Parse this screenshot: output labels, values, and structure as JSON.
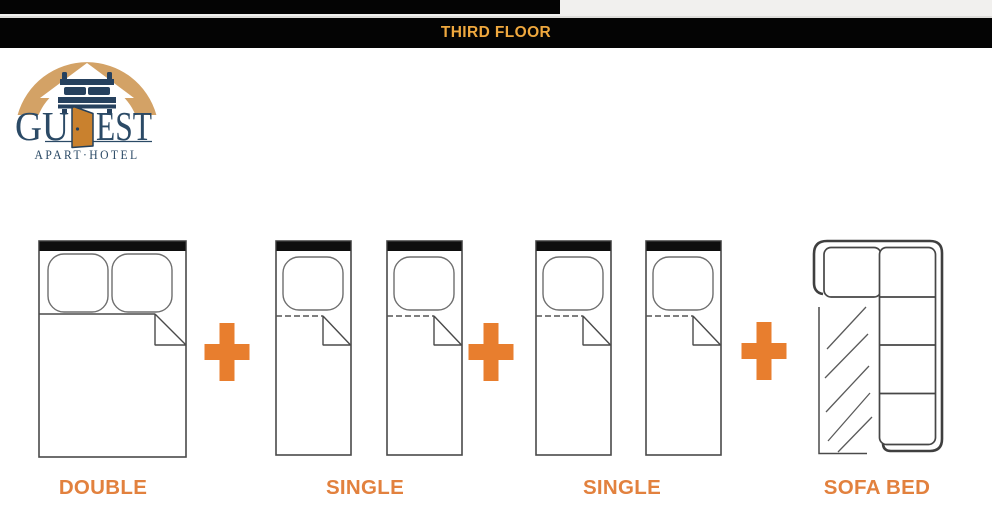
{
  "header": {
    "title": "THIRD FLOOR"
  },
  "logo": {
    "word_left": "GU",
    "word_right": "EST",
    "tagline": "APART·HOTEL"
  },
  "floor_plan": {
    "items": [
      {
        "type": "double-bed",
        "label": "DOUBLE"
      },
      {
        "type": "two-single-beds",
        "label": "SINGLE"
      },
      {
        "type": "two-single-beds",
        "label": "SINGLE"
      },
      {
        "type": "sofa-bed",
        "label": "SOFA BED"
      }
    ]
  },
  "colors": {
    "header_title_gold": "#EFA83E",
    "label_orange": "#E2813E",
    "plus_orange": "#E87E2E",
    "logo_navy": "#2B4A66",
    "logo_tan": "#D3A266",
    "logo_door_orange": "#C9812E",
    "header_bar_black": "#040404"
  }
}
